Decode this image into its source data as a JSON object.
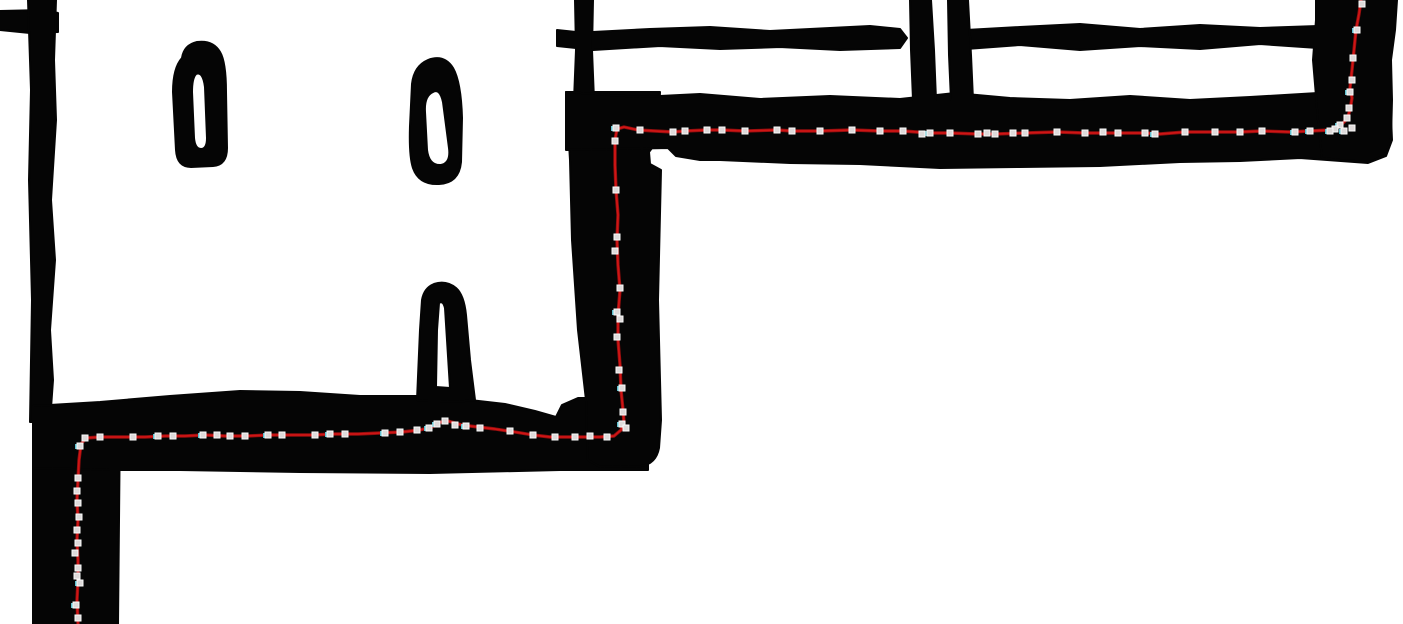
{
  "meta": {
    "width": 1403,
    "height": 624,
    "description": "Hand-drawn floor-plan sketch (black ink on white) with a red traced route and small square waypoint handles following the corridor walls in a staircase pattern"
  },
  "colors": {
    "background": "#ffffff",
    "ink": "#050505",
    "route_bright": "#d01515",
    "route_dark": "#8e0e0e",
    "marker_fill": "#dedada",
    "marker_border": "#fafafa",
    "marker_cyan": "#5fc0cf"
  },
  "drawing": {
    "walls": [
      {
        "name": "wall-top-left-stub",
        "path": "M 0,11 L 44,10 L 58,13 L 58,32 L 30,33 L 0,30 Z"
      },
      {
        "name": "wall-left-vertical",
        "path": "M 28,0 L 56,0 L 54,60 L 56,120 L 51,200 L 55,260 L 50,330 L 53,380 L 50,422 L 30,422 L 32,300 L 29,180 L 31,90 Z"
      },
      {
        "name": "wall-lower-left-column",
        "path": "M 33,416 L 120,416 L 118,624 L 33,624 Z"
      },
      {
        "name": "wall-lower-corridor",
        "path": "M 33,406 L 100,402 L 170,396 L 240,391 L 300,392 L 360,396 L 420,396 L 470,400 L 505,404 L 535,411 L 556,417 L 562,405 L 578,398 L 600,398 L 648,398 L 648,470 L 560,470 L 430,473 L 300,472 L 180,470 L 110,470 L 33,468 Z"
      },
      {
        "name": "wall-central-top-stroke",
        "path": "M 575,0 L 593,0 L 592,50 L 594,100 L 574,100 L 576,50 Z"
      },
      {
        "name": "wall-central-nub",
        "path": "M 557,30 L 576,32 L 576,48 L 557,46 Z"
      },
      {
        "name": "wall-central-column",
        "path": "M 566,92 L 660,92 L 658,140 L 649,152 L 650,164 L 661,170 L 658,300 L 661,420 L 659,448 Q 656,464 641,466 L 600,467 L 588,460 L 586,400 L 578,330 L 572,240 L 570,160 Z"
      },
      {
        "name": "wall-top-band",
        "path": "M 566,92 L 640,97 L 700,94 L 760,99 L 830,96 L 900,99 L 955,93 L 1010,98 L 1070,100 L 1130,96 L 1190,100 L 1250,97 L 1318,93 L 1390,95 L 1392,140 L 1386,156 L 1368,163 L 1300,158 L 1240,161 L 1180,162 L 1100,166 L 1020,167 L 940,168 L 860,164 L 790,163 L 720,160 L 700,160 L 676,156 L 668,148 L 566,150 Z"
      },
      {
        "name": "wall-right-column",
        "path": "M 1316,0 L 1397,0 L 1395,30 L 1391,60 L 1392,100 L 1391,138 L 1385,155 L 1370,162 L 1340,160 L 1322,158 L 1318,120 L 1313,60 L 1316,20 Z"
      },
      {
        "name": "wall-room-stroke-left",
        "path": "M 593,32 L 650,29 L 710,27 L 770,31 L 830,28 L 870,26 L 900,29 L 907,38 L 900,48 L 840,50 L 780,47 L 720,49 L 660,46 L 593,50 Z"
      },
      {
        "name": "wall-room-stroke-right",
        "path": "M 966,30 L 1020,27 L 1080,24 L 1140,29 L 1200,25 L 1260,28 L 1318,26 L 1318,48 L 1260,44 L 1200,49 L 1140,46 L 1080,50 L 1020,45 L 966,49 Z"
      },
      {
        "name": "wall-divider-a",
        "path": "M 910,0 L 931,0 L 934,50 L 936,100 L 913,100 L 911,50 Z"
      },
      {
        "name": "wall-divider-b",
        "path": "M 948,0 L 968,0 L 971,55 L 973,100 L 951,100 L 949,55 Z"
      },
      {
        "name": "pillar-teardrop-1",
        "path": "M 182,58 Q 184,45 197,42 Q 213,40 220,52 Q 226,62 226,92 L 227,148 Q 227,165 213,166 L 191,167 Q 177,167 176,150 L 173,92 Q 173,68 182,58 Z M 196,74 Q 203,71 205,87 L 207,138 Q 207,149 201,149 Q 195,149 194,138 L 192,92 Q 192,78 196,74 Z"
      },
      {
        "name": "pillar-teardrop-2",
        "path": "M 428,60 Q 444,54 453,68 Q 461,82 462,118 L 461,162 Q 459,183 439,184 Q 419,185 413,168 Q 409,156 410,126 L 412,84 Q 414,66 428,60 Z M 433,92 Q 440,88 443,102 L 449,148 Q 451,163 441,165 Q 429,166 427,150 L 425,112 Q 424,96 433,92 Z"
      },
      {
        "name": "pillar-arch",
        "path": "M 417,400 L 420,330 L 422,300 Q 424,288 434,284 Q 446,280 456,288 Q 464,295 466,315 L 470,360 L 475,400 L 455,402 L 440,401 L 428,401 Z M 439,303 Q 443,300 445,308 L 450,388 L 436,387 L 437,330 Z"
      }
    ],
    "route": {
      "stroke_width_bright": 1.8,
      "stroke_width_dark": 3.4,
      "points": [
        [
          1361,
          0
        ],
        [
          1359,
          14
        ],
        [
          1356,
          30
        ],
        [
          1354,
          50
        ],
        [
          1352,
          70
        ],
        [
          1350,
          88
        ],
        [
          1352,
          98
        ],
        [
          1350,
          110
        ],
        [
          1347,
          119
        ],
        [
          1340,
          126
        ],
        [
          1330,
          130
        ],
        [
          1310,
          131
        ],
        [
          1290,
          132
        ],
        [
          1262,
          131
        ],
        [
          1240,
          132
        ],
        [
          1215,
          132
        ],
        [
          1185,
          132
        ],
        [
          1160,
          134
        ],
        [
          1145,
          133
        ],
        [
          1118,
          133
        ],
        [
          1085,
          133
        ],
        [
          1057,
          132
        ],
        [
          1025,
          133
        ],
        [
          995,
          134
        ],
        [
          978,
          134
        ],
        [
          950,
          133
        ],
        [
          930,
          133
        ],
        [
          903,
          131
        ],
        [
          880,
          131
        ],
        [
          852,
          130
        ],
        [
          820,
          131
        ],
        [
          792,
          131
        ],
        [
          777,
          130
        ],
        [
          745,
          131
        ],
        [
          722,
          130
        ],
        [
          707,
          130
        ],
        [
          685,
          131
        ],
        [
          673,
          132
        ],
        [
          655,
          131
        ],
        [
          638,
          130
        ],
        [
          624,
          127
        ],
        [
          617,
          129
        ],
        [
          615,
          140
        ],
        [
          615,
          165
        ],
        [
          616,
          190
        ],
        [
          618,
          215
        ],
        [
          617,
          240
        ],
        [
          618,
          265
        ],
        [
          620,
          290
        ],
        [
          618,
          315
        ],
        [
          618,
          340
        ],
        [
          620,
          365
        ],
        [
          621,
          390
        ],
        [
          623,
          410
        ],
        [
          624,
          423
        ],
        [
          621,
          430
        ],
        [
          614,
          436
        ],
        [
          600,
          437
        ],
        [
          575,
          437
        ],
        [
          550,
          437
        ],
        [
          533,
          435
        ],
        [
          515,
          432
        ],
        [
          495,
          429
        ],
        [
          478,
          427
        ],
        [
          462,
          425
        ],
        [
          448,
          421
        ],
        [
          441,
          422
        ],
        [
          432,
          427
        ],
        [
          420,
          430
        ],
        [
          402,
          432
        ],
        [
          380,
          433
        ],
        [
          358,
          434
        ],
        [
          335,
          434
        ],
        [
          312,
          435
        ],
        [
          290,
          435
        ],
        [
          268,
          435
        ],
        [
          247,
          436
        ],
        [
          225,
          436
        ],
        [
          205,
          435
        ],
        [
          185,
          436
        ],
        [
          165,
          436
        ],
        [
          145,
          437
        ],
        [
          122,
          437
        ],
        [
          100,
          437
        ],
        [
          86,
          438
        ],
        [
          81,
          444
        ],
        [
          79,
          460
        ],
        [
          78,
          480
        ],
        [
          77,
          500
        ],
        [
          78,
          520
        ],
        [
          77,
          540
        ],
        [
          78,
          560
        ],
        [
          78,
          580
        ],
        [
          77,
          600
        ],
        [
          78,
          624
        ]
      ]
    },
    "markers": {
      "size": 6,
      "points": [
        {
          "x": 1362,
          "y": 4,
          "t": "g"
        },
        {
          "x": 1357,
          "y": 30,
          "t": "c"
        },
        {
          "x": 1353,
          "y": 58,
          "t": "g"
        },
        {
          "x": 1352,
          "y": 80,
          "t": "g"
        },
        {
          "x": 1350,
          "y": 92,
          "t": "c"
        },
        {
          "x": 1349,
          "y": 108,
          "t": "g"
        },
        {
          "x": 1347,
          "y": 118,
          "t": "g"
        },
        {
          "x": 1340,
          "y": 125,
          "t": "c"
        },
        {
          "x": 1352,
          "y": 128,
          "t": "g"
        },
        {
          "x": 1344,
          "y": 131,
          "t": "c"
        },
        {
          "x": 1335,
          "y": 129,
          "t": "g"
        },
        {
          "x": 1330,
          "y": 131,
          "t": "c"
        },
        {
          "x": 1310,
          "y": 131,
          "t": "c"
        },
        {
          "x": 1295,
          "y": 132,
          "t": "c"
        },
        {
          "x": 1262,
          "y": 131,
          "t": "g"
        },
        {
          "x": 1240,
          "y": 132,
          "t": "g"
        },
        {
          "x": 1215,
          "y": 132,
          "t": "g"
        },
        {
          "x": 1185,
          "y": 132,
          "t": "g"
        },
        {
          "x": 1155,
          "y": 134,
          "t": "c"
        },
        {
          "x": 1145,
          "y": 133,
          "t": "g"
        },
        {
          "x": 1118,
          "y": 133,
          "t": "g"
        },
        {
          "x": 1103,
          "y": 132,
          "t": "g"
        },
        {
          "x": 1085,
          "y": 133,
          "t": "g"
        },
        {
          "x": 1057,
          "y": 132,
          "t": "g"
        },
        {
          "x": 1025,
          "y": 133,
          "t": "g"
        },
        {
          "x": 1013,
          "y": 133,
          "t": "g"
        },
        {
          "x": 995,
          "y": 134,
          "t": "g"
        },
        {
          "x": 987,
          "y": 133,
          "t": "g"
        },
        {
          "x": 978,
          "y": 134,
          "t": "g"
        },
        {
          "x": 950,
          "y": 133,
          "t": "g"
        },
        {
          "x": 930,
          "y": 133,
          "t": "c"
        },
        {
          "x": 922,
          "y": 134,
          "t": "g"
        },
        {
          "x": 903,
          "y": 131,
          "t": "g"
        },
        {
          "x": 880,
          "y": 131,
          "t": "g"
        },
        {
          "x": 852,
          "y": 130,
          "t": "g"
        },
        {
          "x": 820,
          "y": 131,
          "t": "g"
        },
        {
          "x": 792,
          "y": 131,
          "t": "g"
        },
        {
          "x": 777,
          "y": 130,
          "t": "g"
        },
        {
          "x": 745,
          "y": 131,
          "t": "g"
        },
        {
          "x": 722,
          "y": 130,
          "t": "g"
        },
        {
          "x": 707,
          "y": 130,
          "t": "g"
        },
        {
          "x": 685,
          "y": 131,
          "t": "g"
        },
        {
          "x": 673,
          "y": 132,
          "t": "g"
        },
        {
          "x": 640,
          "y": 130,
          "t": "g"
        },
        {
          "x": 616,
          "y": 128,
          "t": "c"
        },
        {
          "x": 615,
          "y": 141,
          "t": "g"
        },
        {
          "x": 616,
          "y": 190,
          "t": "g"
        },
        {
          "x": 617,
          "y": 237,
          "t": "g"
        },
        {
          "x": 615,
          "y": 251,
          "t": "g"
        },
        {
          "x": 620,
          "y": 288,
          "t": "g"
        },
        {
          "x": 617,
          "y": 312,
          "t": "c"
        },
        {
          "x": 620,
          "y": 319,
          "t": "g"
        },
        {
          "x": 617,
          "y": 337,
          "t": "g"
        },
        {
          "x": 619,
          "y": 370,
          "t": "g"
        },
        {
          "x": 622,
          "y": 388,
          "t": "c"
        },
        {
          "x": 623,
          "y": 412,
          "t": "g"
        },
        {
          "x": 622,
          "y": 424,
          "t": "c"
        },
        {
          "x": 626,
          "y": 428,
          "t": "g"
        },
        {
          "x": 607,
          "y": 437,
          "t": "g"
        },
        {
          "x": 590,
          "y": 436,
          "t": "g"
        },
        {
          "x": 575,
          "y": 437,
          "t": "g"
        },
        {
          "x": 555,
          "y": 437,
          "t": "g"
        },
        {
          "x": 533,
          "y": 435,
          "t": "g"
        },
        {
          "x": 510,
          "y": 431,
          "t": "g"
        },
        {
          "x": 480,
          "y": 428,
          "t": "g"
        },
        {
          "x": 466,
          "y": 426,
          "t": "c"
        },
        {
          "x": 455,
          "y": 425,
          "t": "g"
        },
        {
          "x": 445,
          "y": 421,
          "t": "g"
        },
        {
          "x": 437,
          "y": 424,
          "t": "c"
        },
        {
          "x": 429,
          "y": 428,
          "t": "c"
        },
        {
          "x": 417,
          "y": 430,
          "t": "g"
        },
        {
          "x": 400,
          "y": 432,
          "t": "g"
        },
        {
          "x": 385,
          "y": 433,
          "t": "c"
        },
        {
          "x": 345,
          "y": 434,
          "t": "g"
        },
        {
          "x": 330,
          "y": 434,
          "t": "c"
        },
        {
          "x": 315,
          "y": 435,
          "t": "g"
        },
        {
          "x": 282,
          "y": 435,
          "t": "g"
        },
        {
          "x": 268,
          "y": 435,
          "t": "c"
        },
        {
          "x": 245,
          "y": 436,
          "t": "g"
        },
        {
          "x": 230,
          "y": 436,
          "t": "g"
        },
        {
          "x": 217,
          "y": 435,
          "t": "g"
        },
        {
          "x": 203,
          "y": 435,
          "t": "c"
        },
        {
          "x": 173,
          "y": 436,
          "t": "g"
        },
        {
          "x": 158,
          "y": 436,
          "t": "c"
        },
        {
          "x": 133,
          "y": 437,
          "t": "g"
        },
        {
          "x": 100,
          "y": 437,
          "t": "g"
        },
        {
          "x": 85,
          "y": 438,
          "t": "g"
        },
        {
          "x": 80,
          "y": 446,
          "t": "c"
        },
        {
          "x": 78,
          "y": 478,
          "t": "g"
        },
        {
          "x": 77,
          "y": 491,
          "t": "g"
        },
        {
          "x": 78,
          "y": 503,
          "t": "g"
        },
        {
          "x": 79,
          "y": 517,
          "t": "g"
        },
        {
          "x": 77,
          "y": 530,
          "t": "g"
        },
        {
          "x": 78,
          "y": 543,
          "t": "g"
        },
        {
          "x": 75,
          "y": 553,
          "t": "g"
        },
        {
          "x": 78,
          "y": 568,
          "t": "g"
        },
        {
          "x": 77,
          "y": 576,
          "t": "g"
        },
        {
          "x": 80,
          "y": 583,
          "t": "c"
        },
        {
          "x": 76,
          "y": 605,
          "t": "c"
        },
        {
          "x": 78,
          "y": 618,
          "t": "g"
        }
      ]
    }
  }
}
